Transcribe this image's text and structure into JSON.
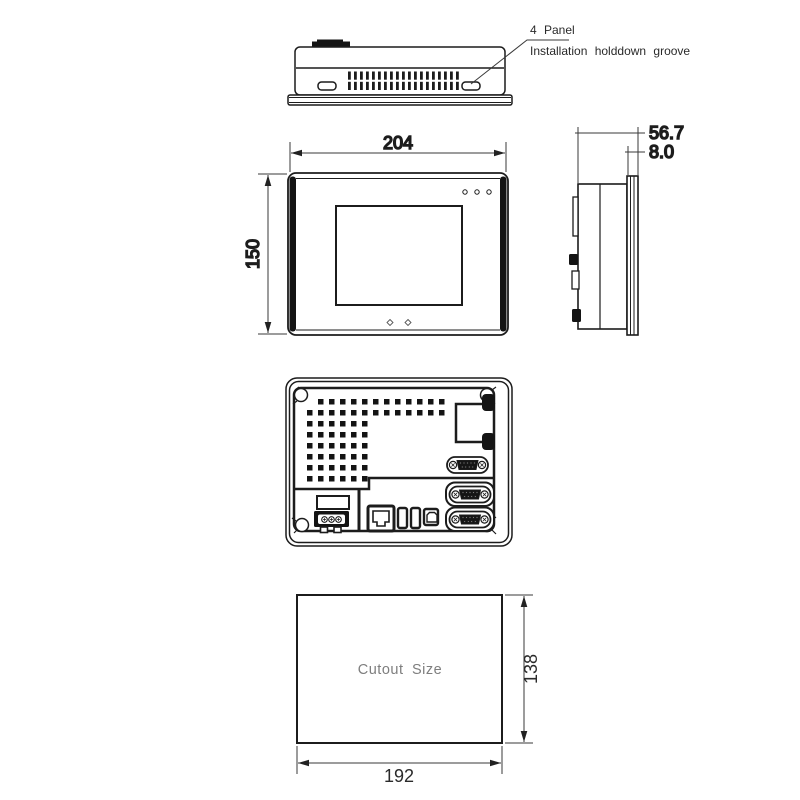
{
  "annotation": {
    "line1": "4 Panel",
    "line2": "Installation holddown groove"
  },
  "dimensions": {
    "front_width": "204",
    "front_height": "150",
    "side_depth": "56.7",
    "side_bezel": "8.0",
    "cutout_width": "192",
    "cutout_height": "138"
  },
  "cutout": {
    "label": "Cutout Size"
  },
  "colors": {
    "line": "#1c1c1c",
    "dim_line": "#3a3a3a",
    "text": "#2a2a2a",
    "cutout_text": "#7e7e7e"
  }
}
